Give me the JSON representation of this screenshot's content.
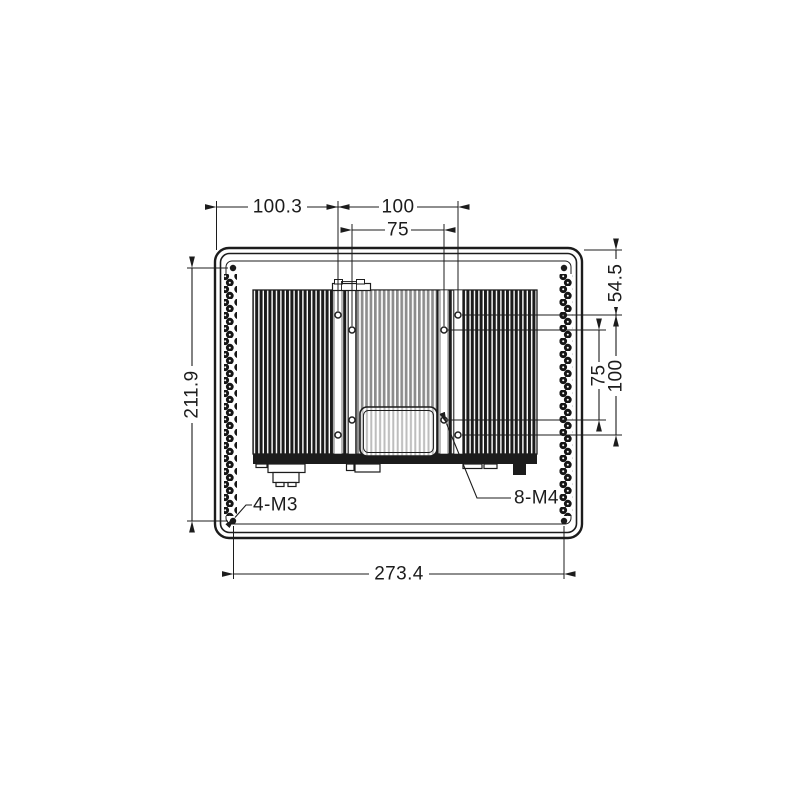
{
  "drawing": {
    "colors": {
      "ink": "#1c1c1c",
      "background": "#ffffff"
    },
    "dimensions": {
      "top_offset_left": "100.3",
      "vesa100_width": "100",
      "vesa75_width": "75",
      "top_edge_to_hole_row": "54.5",
      "vesa75_height": "75",
      "vesa100_height": "100",
      "screw_spacing_vertical": "211.9",
      "screw_spacing_horizontal": "273.4"
    },
    "callouts": {
      "corner_screws": "4-M3",
      "mounting_holes": "8-M4"
    }
  }
}
